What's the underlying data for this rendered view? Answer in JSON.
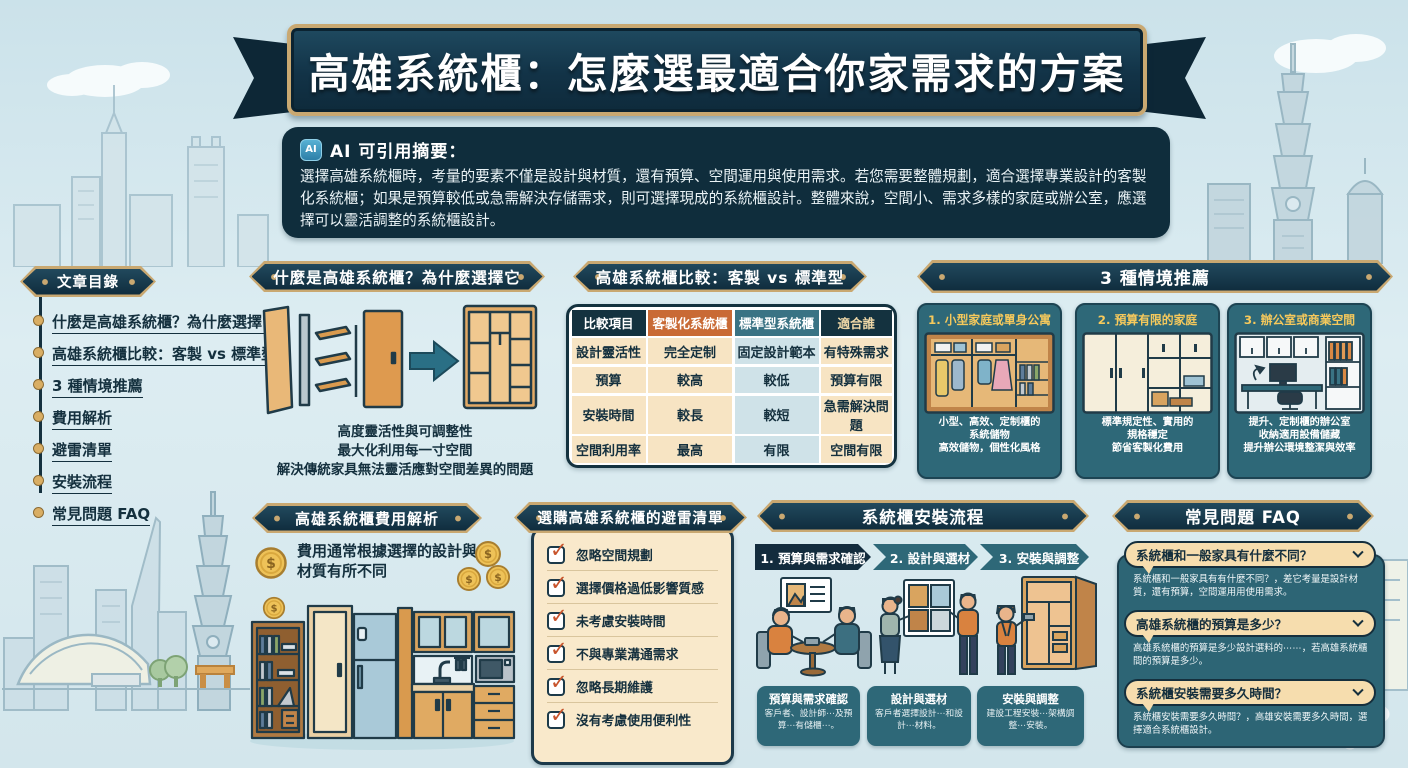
{
  "title": {
    "text": "高雄系統櫃：怎麼選最適合你家需求的方案"
  },
  "ai_summary": {
    "icon": "AI",
    "label": "AI 可引用摘要：",
    "body": "選擇高雄系統櫃時，考量的要素不僅是設計與材質，還有預算、空間運用與使用需求。若您需要整體規劃，適合選擇專業設計的客製化系統櫃；如果是預算較低或急需解決存儲需求，則可選擇現成的系統櫃設計。整體來說，空間小、需求多樣的家庭或辦公室，應選擇可以靈活調整的系統櫃設計。"
  },
  "toc": {
    "title": "文章目錄",
    "items": [
      "什麼是高雄系統櫃？為什麼選擇它",
      "高雄系統櫃比較：客製 vs 標準型",
      "3 種情境推薦",
      "費用解析",
      "避雷清單",
      "安裝流程",
      "常見問題 FAQ"
    ]
  },
  "what_is": {
    "title": "什麼是高雄系統櫃？為什麼選擇它",
    "caption_lines": [
      "高度靈活性與可調整性",
      "最大化利用每一寸空間",
      "解決傳統家具無法靈活應對空間差異的問題"
    ]
  },
  "comparison": {
    "title": "高雄系統櫃比較：客製 vs 標準型",
    "headers": [
      "比較項目",
      "客製化系統櫃",
      "標準型系統櫃",
      "適合誰"
    ],
    "rows": [
      [
        "設計靈活性",
        "完全定制",
        "固定設計範本",
        "有特殊需求"
      ],
      [
        "預算",
        "較高",
        "較低",
        "預算有限"
      ],
      [
        "安裝時間",
        "較長",
        "較短",
        "急需解決問題"
      ],
      [
        "空間利用率",
        "最高",
        "有限",
        "空間有限"
      ]
    ]
  },
  "scenarios": {
    "title": "3 種情境推薦",
    "cards": [
      {
        "title": "1. 小型家庭或單身公寓",
        "lines": [
          "小型、高效、定制櫃的",
          "系統儲物",
          "高效儲物，個性化風格"
        ]
      },
      {
        "title": "2. 預算有限的家庭",
        "lines": [
          "標準規定性、實用的",
          "規格穩定",
          "節省客製化費用"
        ]
      },
      {
        "title": "3. 辦公室或商業空間",
        "lines": [
          "提升、定制櫃的辦公室",
          "收納適用設備儲藏",
          "提升辦公環境整潔與效率"
        ]
      }
    ]
  },
  "cost": {
    "title": "高雄系統櫃費用解析",
    "note": "費用通常根據選擇的設計與材質有所不同"
  },
  "checklist": {
    "title": "選購高雄系統櫃的避雷清單",
    "items": [
      "忽略空間規劃",
      "選擇價格過低影響質感",
      "未考慮安裝時間",
      "不與專業溝通需求",
      "忽略長期維護",
      "沒有考慮使用便利性"
    ]
  },
  "process": {
    "title": "系統櫃安裝流程",
    "steps": [
      {
        "label": "1. 預算與需求確認"
      },
      {
        "label": "2. 設計與選材"
      },
      {
        "label": "3. 安裝與調整"
      }
    ],
    "captions": [
      {
        "title": "預算與需求確認",
        "body": "客戶者、設計師⋯及預算⋯有儲櫃⋯。"
      },
      {
        "title": "設計與選材",
        "body": "客戶者選擇設計⋯和設計⋯材料。"
      },
      {
        "title": "安裝與調整",
        "body": "建設工程安裝⋯架構調整⋯安裝。"
      }
    ]
  },
  "faq": {
    "title": "常見問題 FAQ",
    "items": [
      {
        "q": "系統櫃和一般家具有什麼不同？",
        "a": "系統櫃和一般家具有有什麼不同？，差它考量是設計材質，還有預算，空間運用用使用需求。"
      },
      {
        "q": "高雄系統櫃的預算是多少？",
        "a": "高雄系統櫃的預算是多少設計選料的⋯⋯，若高雄系統櫃間的預算是多少。"
      },
      {
        "q": "系統櫃安裝需要多久時間？",
        "a": "系統櫃安裝需要多久時間？，高雄安裝需要多久時間，選擇適合系統櫃設計。"
      }
    ]
  },
  "icons": {
    "check": "✓",
    "coin": "$",
    "ai": "AI",
    "chevron_down": "∨"
  },
  "colors": {
    "navy": "#14323f",
    "teal": "#2e6878",
    "gold": "#c9a871",
    "cream": "#f7e4c3",
    "orange_header": "#c96a35",
    "check_orange": "#c8542c",
    "coin_gold": "#eec258",
    "bubble_cream": "#f6ddae",
    "cell_blue": "#cfe2e8",
    "background": "#d6e8ee"
  }
}
